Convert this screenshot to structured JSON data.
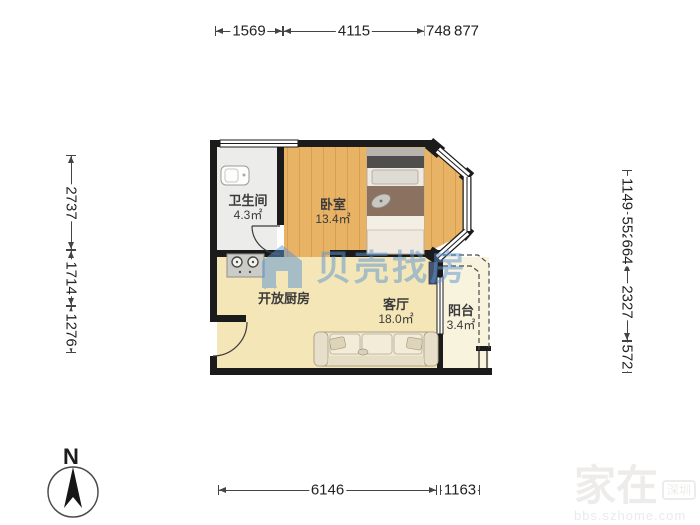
{
  "compass": {
    "label": "N"
  },
  "watermark_center": {
    "brand": "贝壳找房"
  },
  "watermark_corner": {
    "name": "家在",
    "badge": "深圳",
    "url": "bbs.szhome.com"
  },
  "rooms": {
    "bathroom": {
      "name": "卫生间",
      "area": "4.3㎡"
    },
    "bedroom": {
      "name": "卧室",
      "area": "13.4㎡"
    },
    "kitchen": {
      "name": "开放厨房"
    },
    "living": {
      "name": "客厅",
      "area": "18.0㎡"
    },
    "balcony": {
      "name": "阳台",
      "area": "3.4㎡"
    }
  },
  "dimensions": {
    "top": [
      "1569",
      "4115",
      "748",
      "877"
    ],
    "bottom": [
      "6146",
      "1163"
    ],
    "left": [
      "2737",
      "1714",
      "1276"
    ],
    "right": [
      "1149",
      "552",
      "664",
      "2327",
      "572"
    ]
  },
  "colors": {
    "wall": "#1b1b1b",
    "wood_floor": "#e9b366",
    "wood_line": "#d79f4f",
    "tile_floor": "#f4e6b6",
    "bath_floor": "#ececea",
    "balcony_floor": "#f8f3dc",
    "dim_line": "#444444",
    "dim_text": "#222222",
    "label_text": "#3b3b3b",
    "watermark_blue": "#5b95d5"
  }
}
